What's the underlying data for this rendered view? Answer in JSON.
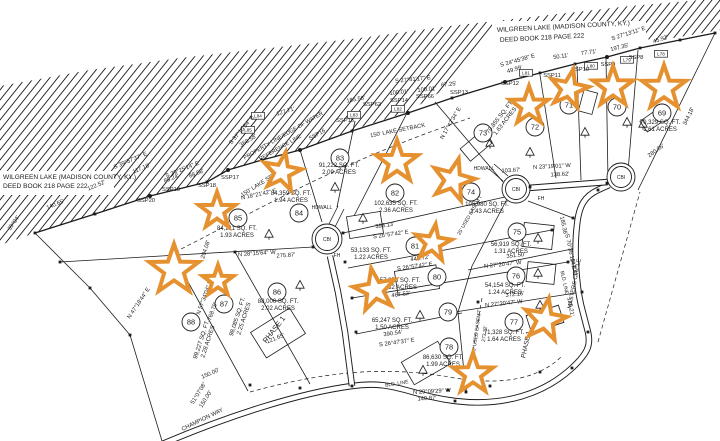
{
  "style": {
    "ink": "#1c1c1c",
    "bg": "#ffffff",
    "star": "#e5912f"
  },
  "lake": {
    "polygon": "0,86 90,70 180,58 270,48 360,38 450,26 540,16 630,6 700,0 720,0 720,30 650,42 640,24 500,22 470,60 440,92 408,112 352,130 300,150 262,160 228,170 207,182 150,196 95,214 35,233 0,245",
    "shoreline": [
      [
        35,
        233
      ],
      [
        95,
        214
      ],
      [
        150,
        196
      ],
      [
        207,
        182
      ],
      [
        228,
        170
      ],
      [
        262,
        160
      ],
      [
        300,
        150
      ],
      [
        352,
        131
      ],
      [
        408,
        113
      ],
      [
        452,
        98
      ],
      [
        505,
        82
      ],
      [
        540,
        73
      ],
      [
        575,
        64
      ],
      [
        607,
        57
      ],
      [
        640,
        48
      ],
      [
        680,
        40
      ],
      [
        715,
        33
      ]
    ],
    "text_notches": [
      [
        0,
        171,
        114,
        24
      ],
      [
        492,
        21,
        154,
        28
      ]
    ]
  },
  "deed_notes": [
    {
      "t": "WILGREEN LAKE (MADISON COUNTY, KY.)",
      "x": 3,
      "y": 179,
      "r": 0,
      "s": 6.6,
      "a": "s"
    },
    {
      "t": "DEED BOOK 218 PAGE 222",
      "x": 3,
      "y": 188,
      "r": 0,
      "s": 6.6,
      "a": "s"
    },
    {
      "t": "WILGREEN LAKE (MADISON COUNTY, KY.)",
      "x": 497,
      "y": 32,
      "r": -3,
      "s": 6.6,
      "a": "s"
    },
    {
      "t": "DEED BOOK 218 PAGE 222",
      "x": 500,
      "y": 42,
      "r": -3,
      "s": 6.6,
      "a": "s"
    }
  ],
  "roads": [
    {
      "name": "champion-way-masters-circle",
      "d": "M160,445 C230,415 300,393 352,386 C395,380 408,395 455,401 C505,407 545,393 572,368 C588,353 591,345 588,332 L581,305 C576,283 574,250 577,225 C579,205 585,196 598,190 L609,185"
    },
    {
      "name": "cul-de-sac-approach-west",
      "d": "M330,256 L338,292 345,332 352,386"
    },
    {
      "name": "cul-de-sac-connector-east",
      "d": "M528,188 L608,182"
    }
  ],
  "culdesacs": [
    {
      "x": 327,
      "y": 239,
      "r": 15,
      "label": "CBI"
    },
    {
      "x": 516,
      "y": 189,
      "r": 14,
      "label": "CBI"
    },
    {
      "x": 621,
      "y": 177,
      "r": 14,
      "label": "CBI"
    }
  ],
  "boundaries": [
    [
      35,
      233,
      90,
      288
    ],
    [
      90,
      288,
      130,
      335
    ],
    [
      130,
      335,
      162,
      441
    ],
    [
      60,
      262,
      313,
      247
    ],
    [
      176,
      260,
      248,
      391
    ],
    [
      235,
      252,
      310,
      384
    ],
    [
      300,
      150,
      322,
      222
    ],
    [
      355,
      121,
      337,
      207
    ],
    [
      408,
      111,
      354,
      216
    ],
    [
      343,
      233,
      505,
      197
    ],
    [
      348,
      268,
      552,
      230
    ],
    [
      352,
      298,
      568,
      262
    ],
    [
      356,
      334,
      462,
      313
    ],
    [
      455,
      312,
      582,
      292
    ],
    [
      468,
      270,
      577,
      248
    ],
    [
      528,
      201,
      573,
      218
    ],
    [
      435,
      102,
      503,
      182
    ],
    [
      540,
      75,
      556,
      178
    ],
    [
      577,
      66,
      581,
      180
    ],
    [
      606,
      58,
      608,
      180
    ],
    [
      638,
      50,
      627,
      184
    ],
    [
      715,
      33,
      638,
      190
    ],
    [
      507,
      199,
      472,
      266
    ],
    [
      472,
      266,
      458,
      312
    ],
    [
      458,
      312,
      466,
      392
    ],
    [
      329,
      224,
      338,
      206
    ],
    [
      335,
      227,
      344,
      209
    ],
    [
      503,
      181,
      489,
      169
    ],
    [
      508,
      176,
      494,
      164
    ]
  ],
  "dashed": [
    "M250,392 C330,370 390,366 455,378 C505,386 540,378 562,356",
    "M482,298 L466,392",
    "M598,342 L640,192",
    "M175,252 C250,215 330,165 470,118"
  ],
  "lots": [
    {
      "n": "69",
      "cx": 662,
      "cy": 113,
      "area": "70,329 SQ. FT.",
      "acres": "1.61 ACRES",
      "lx": 660,
      "ly": 124,
      "lr": 0
    },
    {
      "n": "70",
      "cx": 617,
      "cy": 107
    },
    {
      "n": "71",
      "cx": 569,
      "cy": 105
    },
    {
      "n": "72",
      "cx": 535,
      "cy": 127
    },
    {
      "n": "73",
      "cx": 483,
      "cy": 133,
      "area": "70,855 SQ. FT.",
      "acres": "1.63 ACRES",
      "lx": 501,
      "ly": 118,
      "lr": -52
    },
    {
      "n": "74",
      "cx": 471,
      "cy": 192,
      "area": "105,980 SQ. FT.",
      "acres": "2.43 ACRES",
      "lx": 487,
      "ly": 206,
      "lr": 0
    },
    {
      "n": "75",
      "cx": 517,
      "cy": 232,
      "area": "56,919 SQ. FT.",
      "acres": "1.31 ACRES",
      "lx": 511,
      "ly": 246,
      "lr": 0
    },
    {
      "n": "76",
      "cx": 516,
      "cy": 276,
      "area": "54,154 SQ. FT.",
      "acres": "1.24 ACRES",
      "lx": 505,
      "ly": 287,
      "lr": 0
    },
    {
      "n": "77",
      "cx": 514,
      "cy": 322,
      "area": "71,328 SQ. FT.",
      "acres": "1.64 ACRES",
      "lx": 504,
      "ly": 334,
      "lr": 0
    },
    {
      "n": "78",
      "cx": 449,
      "cy": 347,
      "area": "86,630 SQ. FT.",
      "acres": "1.99 ACRES",
      "lx": 443,
      "ly": 359,
      "lr": 0
    },
    {
      "n": "79",
      "cx": 448,
      "cy": 312,
      "area": "65,247 SQ. FT.",
      "acres": "1.50 ACRES",
      "lx": 392,
      "ly": 322,
      "lr": 0
    },
    {
      "n": "80",
      "cx": 437,
      "cy": 277,
      "area": "57,358 SQ. FT.",
      "acres": "1.32 ACRES",
      "lx": 400,
      "ly": 282,
      "lr": 0
    },
    {
      "n": "81",
      "cx": 415,
      "cy": 246,
      "area": "53,133 SQ. FT.",
      "acres": "1.22 ACRES",
      "lx": 371,
      "ly": 252,
      "lr": 0
    },
    {
      "n": "82",
      "cx": 395,
      "cy": 193,
      "area": "102,635 SQ. FT.",
      "acres": "2.36 ACRES",
      "lx": 396,
      "ly": 205,
      "lr": 0
    },
    {
      "n": "83",
      "cx": 340,
      "cy": 158,
      "area": "91,222 SQ. FT.",
      "acres": "2.09 ACRES",
      "lx": 339,
      "ly": 167,
      "lr": 0
    },
    {
      "n": "84",
      "cx": 299,
      "cy": 213,
      "area": "84,359 SQ. FT.",
      "acres": "1.94 ACRES",
      "lx": 291,
      "ly": 195,
      "lr": 0
    },
    {
      "n": "85",
      "cx": 238,
      "cy": 218,
      "area": "84,211 SQ. FT.",
      "acres": "1.93 ACRES",
      "lx": 237,
      "ly": 230,
      "lr": 0
    },
    {
      "n": "86",
      "cx": 277,
      "cy": 292,
      "area": "88,000 SQ. FT.",
      "acres": "2.02 ACRES",
      "lx": 278,
      "ly": 303,
      "lr": 0
    },
    {
      "n": "87",
      "cx": 224,
      "cy": 304,
      "area": "98,085 SQ. FT.",
      "acres": "2.25 ACRES",
      "lx": 239,
      "ly": 317,
      "lr": -72
    },
    {
      "n": "88",
      "cx": 191,
      "cy": 322,
      "area": "99,227 SQ. FT.",
      "acres": "2.28 ACRES",
      "lx": 203,
      "ly": 340,
      "lr": -72
    }
  ],
  "labels": [
    {
      "t": "S 39°57'37\" E",
      "x": 131,
      "y": 162,
      "r": -23
    },
    {
      "t": "117.18'",
      "x": 142,
      "y": 170,
      "r": -23
    },
    {
      "t": "122.52'",
      "x": 97,
      "y": 187,
      "r": -23
    },
    {
      "t": "140.65'",
      "x": 56,
      "y": 206,
      "r": -23
    },
    {
      "t": "S 39°25'14\" E",
      "x": 183,
      "y": 171,
      "r": -22
    },
    {
      "t": "85.24'",
      "x": 172,
      "y": 180,
      "r": -22
    },
    {
      "t": "88.58'",
      "x": 197,
      "y": 175,
      "r": -22
    },
    {
      "t": "368.58'",
      "x": 249,
      "y": 142,
      "r": -32
    },
    {
      "t": "S 37°10'54\" E",
      "x": 243,
      "y": 131,
      "r": -50
    },
    {
      "t": "127.71'",
      "x": 286,
      "y": 113,
      "r": -17
    },
    {
      "t": "185.58'",
      "x": 356,
      "y": 101,
      "r": -10
    },
    {
      "t": "S 27°41'17\" E",
      "x": 413,
      "y": 81,
      "r": -6
    },
    {
      "t": "100.01'",
      "x": 399,
      "y": 94,
      "r": -6
    },
    {
      "t": "100.01'",
      "x": 427,
      "y": 91,
      "r": -6
    },
    {
      "t": "67.25'",
      "x": 449,
      "y": 86,
      "r": -6
    },
    {
      "t": "S 24°45'38\" E",
      "x": 518,
      "y": 62,
      "r": -16
    },
    {
      "t": "49.99'",
      "x": 515,
      "y": 71,
      "r": -16
    },
    {
      "t": "50.11'",
      "x": 561,
      "y": 58,
      "r": -8
    },
    {
      "t": "77.71'",
      "x": 589,
      "y": 54,
      "r": -8
    },
    {
      "t": "197.35'",
      "x": 620,
      "y": 49,
      "r": -14
    },
    {
      "t": "S 27°13'11\" E",
      "x": 629,
      "y": 35,
      "r": -18
    },
    {
      "t": "45.92'",
      "x": 661,
      "y": 41,
      "r": -18
    },
    {
      "t": "280.86'",
      "x": 657,
      "y": 152,
      "r": -36
    },
    {
      "t": "344.18'",
      "x": 690,
      "y": 117,
      "r": -64
    },
    {
      "t": "N 23°19'01\" W",
      "x": 552,
      "y": 168,
      "r": -3
    },
    {
      "t": "138.62'",
      "x": 560,
      "y": 176,
      "r": -3
    },
    {
      "t": "103.67'",
      "x": 511,
      "y": 172,
      "r": -3
    },
    {
      "t": "393.13'",
      "x": 385,
      "y": 227,
      "r": -8
    },
    {
      "t": "S 26°57'42\" E",
      "x": 391,
      "y": 236,
      "r": -8
    },
    {
      "t": "445.72'",
      "x": 420,
      "y": 260,
      "r": -8
    },
    {
      "t": "S 26°57'42\" E",
      "x": 415,
      "y": 268,
      "r": -8
    },
    {
      "t": "467.52'",
      "x": 401,
      "y": 296,
      "r": -8
    },
    {
      "t": "390.54'",
      "x": 393,
      "y": 335,
      "r": -8
    },
    {
      "t": "S 26°47'37\" E",
      "x": 397,
      "y": 344,
      "r": -8
    },
    {
      "t": "N 27°20'47\" W",
      "x": 504,
      "y": 305,
      "r": -6
    },
    {
      "t": "372.16'",
      "x": 515,
      "y": 296,
      "r": -6
    },
    {
      "t": "351.50'",
      "x": 516,
      "y": 257,
      "r": -6
    },
    {
      "t": "N 27°20'47\" W",
      "x": 503,
      "y": 266,
      "r": -6
    },
    {
      "t": "185.36'",
      "x": 562,
      "y": 226,
      "r": 78
    },
    {
      "t": "S 70°36'10\" E",
      "x": 569,
      "y": 252,
      "r": 78
    },
    {
      "t": "147.42'",
      "x": 572,
      "y": 268,
      "r": 80
    },
    {
      "t": "135.21'",
      "x": 569,
      "y": 307,
      "r": 80
    },
    {
      "t": "N 29°09'29\" W",
      "x": 432,
      "y": 393,
      "r": -3
    },
    {
      "t": "140.87'",
      "x": 427,
      "y": 400,
      "r": -3
    },
    {
      "t": "N 28°15'64\" W",
      "x": 257,
      "y": 255,
      "r": -4
    },
    {
      "t": "275.87'",
      "x": 286,
      "y": 257,
      "r": -4
    },
    {
      "t": "204.08'",
      "x": 207,
      "y": 250,
      "r": -72
    },
    {
      "t": "N 18°21'42\" E",
      "x": 259,
      "y": 196,
      "r": -12
    },
    {
      "t": "N 47°18'44\" E",
      "x": 140,
      "y": 304,
      "r": -56
    },
    {
      "t": "N 57°34'04\" E",
      "x": 206,
      "y": 298,
      "r": -70
    },
    {
      "t": "768.79'",
      "x": 214,
      "y": 312,
      "r": -70
    },
    {
      "t": "51°07'08\"",
      "x": 200,
      "y": 394,
      "r": -58
    },
    {
      "t": "150.00'",
      "x": 207,
      "y": 400,
      "r": -58
    },
    {
      "t": "150.00'",
      "x": 211,
      "y": 375,
      "r": -24
    },
    {
      "t": "121.65'",
      "x": 276,
      "y": 340,
      "r": -22
    },
    {
      "t": "BLD. LINE",
      "x": 397,
      "y": 385,
      "r": -9,
      "s": 5
    },
    {
      "t": "BLD. LINE",
      "x": 563,
      "y": 283,
      "r": 78,
      "s": 5
    },
    {
      "t": "25' USED EASEM'T",
      "x": 478,
      "y": 332,
      "r": -82,
      "s": 5
    },
    {
      "t": "273.32'",
      "x": 486,
      "y": 334,
      "r": -82,
      "s": 5
    },
    {
      "t": "25' USED EASEM'T",
      "x": 471,
      "y": 216,
      "r": -60,
      "s": 5
    },
    {
      "t": "150' LAKE SETBACK",
      "x": 398,
      "y": 132,
      "r": -11
    },
    {
      "t": "150' LAKE SETBACK",
      "x": 266,
      "y": 182,
      "r": -32
    },
    {
      "t": "N 17°42'34\" E",
      "x": 452,
      "y": 124,
      "r": -60
    },
    {
      "t": "39°04'",
      "x": 15,
      "y": 224,
      "r": -55
    },
    {
      "t": "PROPERTY LINE/EDGE OF WATER",
      "x": 284,
      "y": 137,
      "r": -30,
      "s": 5.5
    },
    {
      "t": "REFERENCE LINE",
      "x": 281,
      "y": 149,
      "r": -30,
      "s": 5.5
    },
    {
      "t": "SSP16",
      "x": 318,
      "y": 136,
      "r": -30
    },
    {
      "t": "SSP15",
      "x": 345,
      "y": 122,
      "r": 0
    },
    {
      "t": "SSP62",
      "x": 372,
      "y": 106,
      "r": 0
    },
    {
      "t": "SSP14",
      "x": 399,
      "y": 102,
      "r": 0
    },
    {
      "t": "SSP66",
      "x": 425,
      "y": 98,
      "r": 0
    },
    {
      "t": "SSP13",
      "x": 459,
      "y": 94,
      "r": 0
    },
    {
      "t": "SSP12",
      "x": 510,
      "y": 85,
      "r": 0
    },
    {
      "t": "SSP11",
      "x": 552,
      "y": 77,
      "r": 0
    },
    {
      "t": "SSP10",
      "x": 580,
      "y": 71,
      "r": 0
    },
    {
      "t": "SSP9",
      "x": 608,
      "y": 66,
      "r": 0
    },
    {
      "t": "SSP8",
      "x": 636,
      "y": 59,
      "r": 0
    },
    {
      "t": "SSP17",
      "x": 230,
      "y": 179,
      "r": 0
    },
    {
      "t": "SSP18",
      "x": 207,
      "y": 187,
      "r": 0
    },
    {
      "t": "SSP19",
      "x": 171,
      "y": 191,
      "r": 0
    },
    {
      "t": "SSP20",
      "x": 146,
      "y": 202,
      "r": 0
    },
    {
      "t": "HDWALL",
      "x": 322,
      "y": 209,
      "r": 0,
      "s": 5
    },
    {
      "t": "HDWALL",
      "x": 484,
      "y": 170,
      "r": 0,
      "s": 5
    },
    {
      "t": "FH",
      "x": 337,
      "y": 257,
      "r": 0,
      "s": 5
    },
    {
      "t": "FH",
      "x": 541,
      "y": 200,
      "r": 0,
      "s": 5
    },
    {
      "t": "PHASE 1",
      "x": 276,
      "y": 331,
      "r": -52,
      "s": 7.5
    },
    {
      "t": "PHASE 1",
      "x": 528,
      "y": 345,
      "r": -78,
      "s": 6.5
    },
    {
      "t": "CHAMPION WAY",
      "x": 203,
      "y": 421,
      "r": -26
    },
    {
      "t": "MASTERS CIRCLE",
      "x": 576,
      "y": 284,
      "r": -79
    }
  ],
  "tags": [
    {
      "t": "L85",
      "x": 248,
      "y": 131
    },
    {
      "t": "L84",
      "x": 258,
      "y": 117
    },
    {
      "t": "L83",
      "x": 354,
      "y": 116
    },
    {
      "t": "L82",
      "x": 398,
      "y": 110
    },
    {
      "t": "L81",
      "x": 526,
      "y": 74
    },
    {
      "t": "L80",
      "x": 591,
      "y": 67
    },
    {
      "t": "L79",
      "x": 627,
      "y": 61
    },
    {
      "t": "L78",
      "x": 661,
      "y": 55
    }
  ],
  "squares": [
    [
      35,
      233
    ],
    [
      95,
      214
    ],
    [
      150,
      196
    ],
    [
      207,
      182
    ],
    [
      228,
      170
    ],
    [
      262,
      160
    ],
    [
      300,
      150
    ],
    [
      352,
      131
    ],
    [
      408,
      113
    ],
    [
      452,
      98
    ],
    [
      505,
      82
    ],
    [
      540,
      73
    ],
    [
      575,
      64
    ],
    [
      607,
      57
    ],
    [
      640,
      48
    ],
    [
      680,
      40
    ],
    [
      715,
      33
    ],
    [
      90,
      288
    ],
    [
      130,
      335
    ],
    [
      352,
      386
    ],
    [
      455,
      401
    ],
    [
      572,
      368
    ],
    [
      588,
      332
    ],
    [
      598,
      190
    ],
    [
      530,
      187
    ],
    [
      607,
      183
    ],
    [
      343,
      233
    ],
    [
      345,
      262
    ],
    [
      352,
      298
    ],
    [
      356,
      332
    ],
    [
      478,
      302
    ],
    [
      466,
      392
    ],
    [
      552,
      230
    ],
    [
      568,
      262
    ],
    [
      573,
      218
    ],
    [
      582,
      292
    ],
    [
      250,
      385
    ],
    [
      300,
      388
    ],
    [
      448,
      390
    ],
    [
      490,
      386
    ],
    [
      540,
      372
    ],
    [
      176,
      260
    ],
    [
      235,
      252
    ],
    [
      313,
      247
    ],
    [
      60,
      262
    ]
  ],
  "dots": [
    [
      150,
      196
    ],
    [
      300,
      150
    ],
    [
      408,
      113
    ],
    [
      505,
      82
    ],
    [
      607,
      57
    ],
    [
      228,
      170
    ]
  ],
  "triangles": [
    [
      335,
      187
    ],
    [
      269,
      234
    ],
    [
      300,
      285
    ],
    [
      363,
      218
    ],
    [
      490,
      143
    ],
    [
      530,
      152
    ],
    [
      585,
      132
    ],
    [
      627,
      122
    ],
    [
      643,
      124
    ],
    [
      538,
      238
    ],
    [
      538,
      273
    ],
    [
      540,
      305
    ],
    [
      420,
      315
    ],
    [
      423,
      370
    ]
  ],
  "buildings": [
    {
      "x": 348,
      "y": 214,
      "w": 34,
      "h": 22,
      "rot": -9
    },
    {
      "x": 396,
      "y": 268,
      "w": 42,
      "h": 24,
      "rot": -9
    },
    {
      "x": 405,
      "y": 350,
      "w": 42,
      "h": 26,
      "rot": -30
    },
    {
      "x": 523,
      "y": 224,
      "w": 30,
      "h": 24,
      "rot": 6
    },
    {
      "x": 527,
      "y": 263,
      "w": 28,
      "h": 20,
      "rot": 6
    },
    {
      "x": 528,
      "y": 310,
      "w": 34,
      "h": 18,
      "rot": -18
    },
    {
      "x": 255,
      "y": 318,
      "w": 46,
      "h": 30,
      "rot": -32
    },
    {
      "x": 462,
      "y": 138,
      "w": 28,
      "h": 16,
      "rot": -40
    },
    {
      "x": 577,
      "y": 95,
      "w": 22,
      "h": 14,
      "rot": -75
    },
    {
      "x": 642,
      "y": 115,
      "w": 18,
      "h": 13,
      "rot": -35
    }
  ],
  "stars": [
    [
      174,
      270,
      26,
      0
    ],
    [
      218,
      281,
      16,
      0
    ],
    [
      217,
      211,
      19,
      0
    ],
    [
      282,
      172,
      20,
      10
    ],
    [
      397,
      162,
      22,
      0
    ],
    [
      453,
      180,
      22,
      15
    ],
    [
      433,
      243,
      19,
      8
    ],
    [
      375,
      290,
      22,
      -10
    ],
    [
      529,
      106,
      20,
      0
    ],
    [
      569,
      89,
      20,
      12
    ],
    [
      613,
      87,
      21,
      0
    ],
    [
      664,
      88,
      23,
      0
    ],
    [
      545,
      320,
      22,
      10
    ],
    [
      473,
      374,
      21,
      0
    ]
  ]
}
